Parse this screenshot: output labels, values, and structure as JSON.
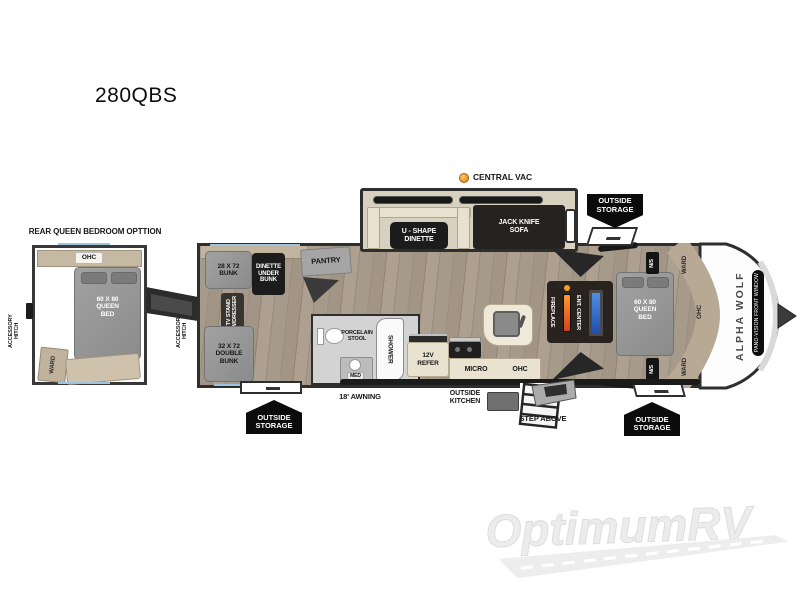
{
  "title": "280QBS",
  "callouts": {
    "central_vac": "CENTRAL VAC",
    "outside_storage": "OUTSIDE\nSTORAGE",
    "awning": "18' AWNING",
    "outside_kitchen": "OUTSIDE\nKITCHEN",
    "step_above": "STEP ABOVE"
  },
  "inset": {
    "title": "REAR QUEEN BEDROOM OPTTION",
    "ohc": "OHC",
    "queen_bed": "60 X 80\nQUEEN\nBED",
    "ward": "WARD",
    "accessory_hitch": "ACCESSORY\nHITCH"
  },
  "main": {
    "bunk_28": "28 X 72\nBUNK",
    "dinette_under_bunk": "DINETTE\nUNDER\nBUNK",
    "pantry": "PANTRY",
    "tv_stand": "TV STAND\nW/DRESSER",
    "double_bunk": "32 X 72\nDOUBLE\nBUNK",
    "u_shape_dinette": "U - SHAPE\nDINETTE",
    "jack_knife_sofa": "JACK KNIFE\nSOFA",
    "porcelain_stool": "PORCELAIN\nSTOOL",
    "shower": "SHOWER",
    "med": "MED",
    "refer": "12V\nREFER",
    "micro": "MICRO",
    "ohc_kitchen": "OHC",
    "fireplace": "FIREPLACE",
    "ent_center": "ENT. CENTER",
    "queen_bed": "60 X 80\nQUEEN\nBED",
    "night_stand": "N/S",
    "ward": "WARD",
    "ohc_front": "OHC",
    "brand": "ALPHA WOLF",
    "front_window": "PANO-VISION FRONT WINDOW"
  },
  "watermark": "OptimumRV",
  "colors": {
    "accent_orange": "#f59a23",
    "tv_blue": "#3a6fd8",
    "badge_black": "#0b0b0b",
    "trim_blue": "#9cc4de",
    "floor_wood": "#9c9183",
    "slide_cream": "#d8d1bf"
  }
}
